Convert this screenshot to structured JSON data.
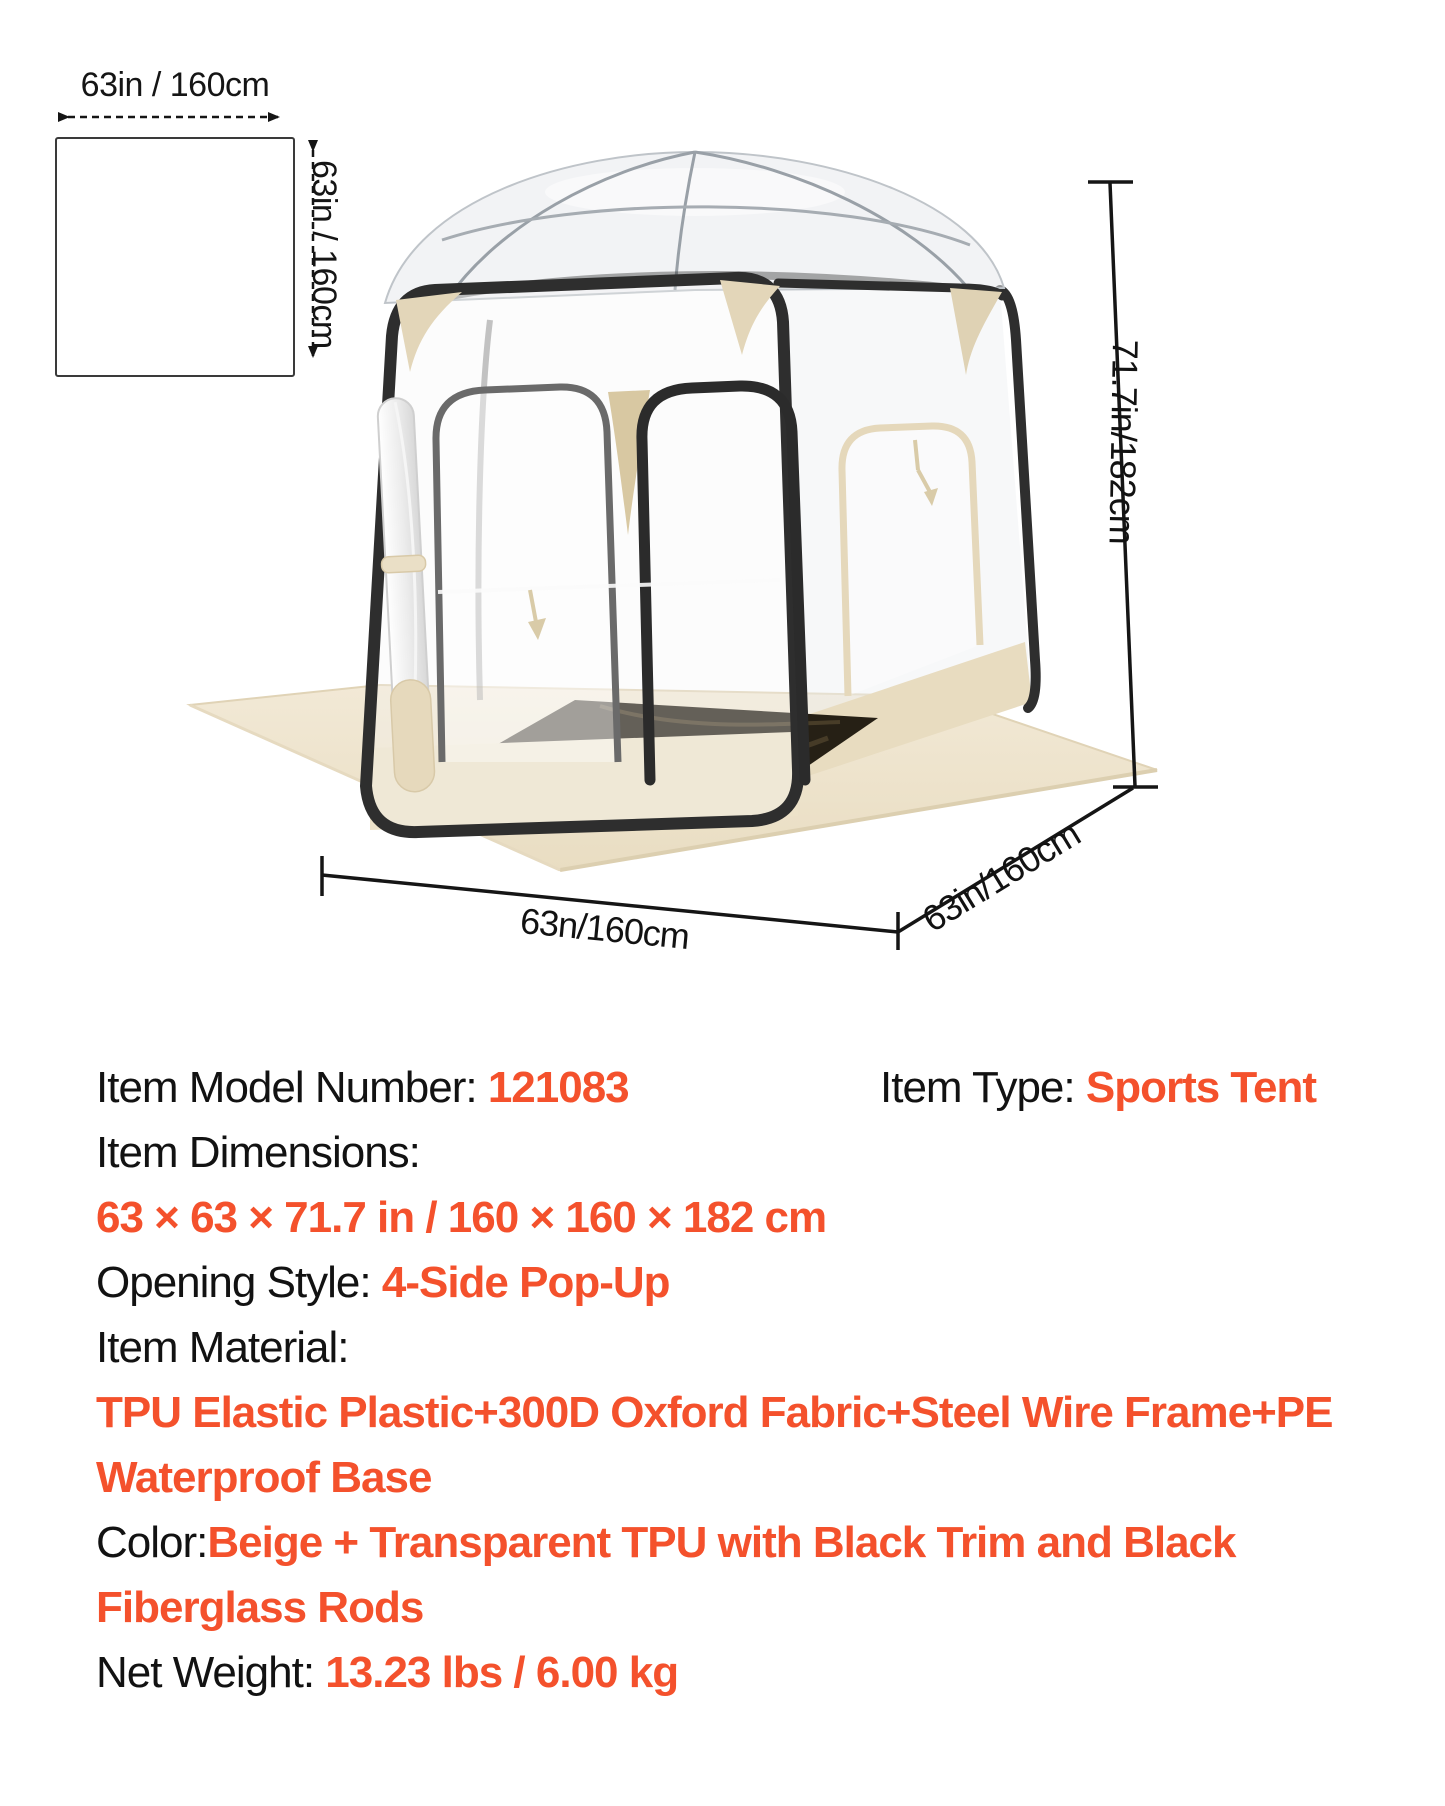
{
  "colors": {
    "accent": "#F4512C",
    "text": "#121212",
    "trim_black": "#2E2E2E",
    "fabric_beige": "#EADFC5",
    "fabric_beige_dark": "#D8C8A2",
    "groundsheet": "#EFE5CF",
    "floor_mat": "#262015"
  },
  "floor_diagram": {
    "width_label": "63in / 160cm",
    "depth_label": "63in / 160cm"
  },
  "tent_dimensions": {
    "height_label": "71.7in/182cm",
    "front_width_label": "63n/160cm",
    "side_depth_label": "63in/160cm"
  },
  "specs": {
    "model": {
      "label": "Item Model Number: ",
      "value": "121083"
    },
    "type": {
      "label": "Item Type: ",
      "value": "Sports Tent"
    },
    "dimensions": {
      "label": "Item Dimensions:",
      "value": "63 × 63 × 71.7 in / 160 × 160 × 182 cm"
    },
    "opening": {
      "label": "Opening Style: ",
      "value": "4-Side Pop-Up"
    },
    "material": {
      "label": "Item Material:",
      "value_line1": "TPU Elastic Plastic+300D Oxford Fabric+Steel Wire Frame+PE",
      "value_line2": "Waterproof Base"
    },
    "color": {
      "label": "Color:",
      "value_line1": "Beige + Transparent TPU with Black Trim and Black",
      "value_line2": "Fiberglass Rods"
    },
    "weight": {
      "label": "Net Weight: ",
      "value": "13.23 lbs / 6.00 kg"
    }
  }
}
